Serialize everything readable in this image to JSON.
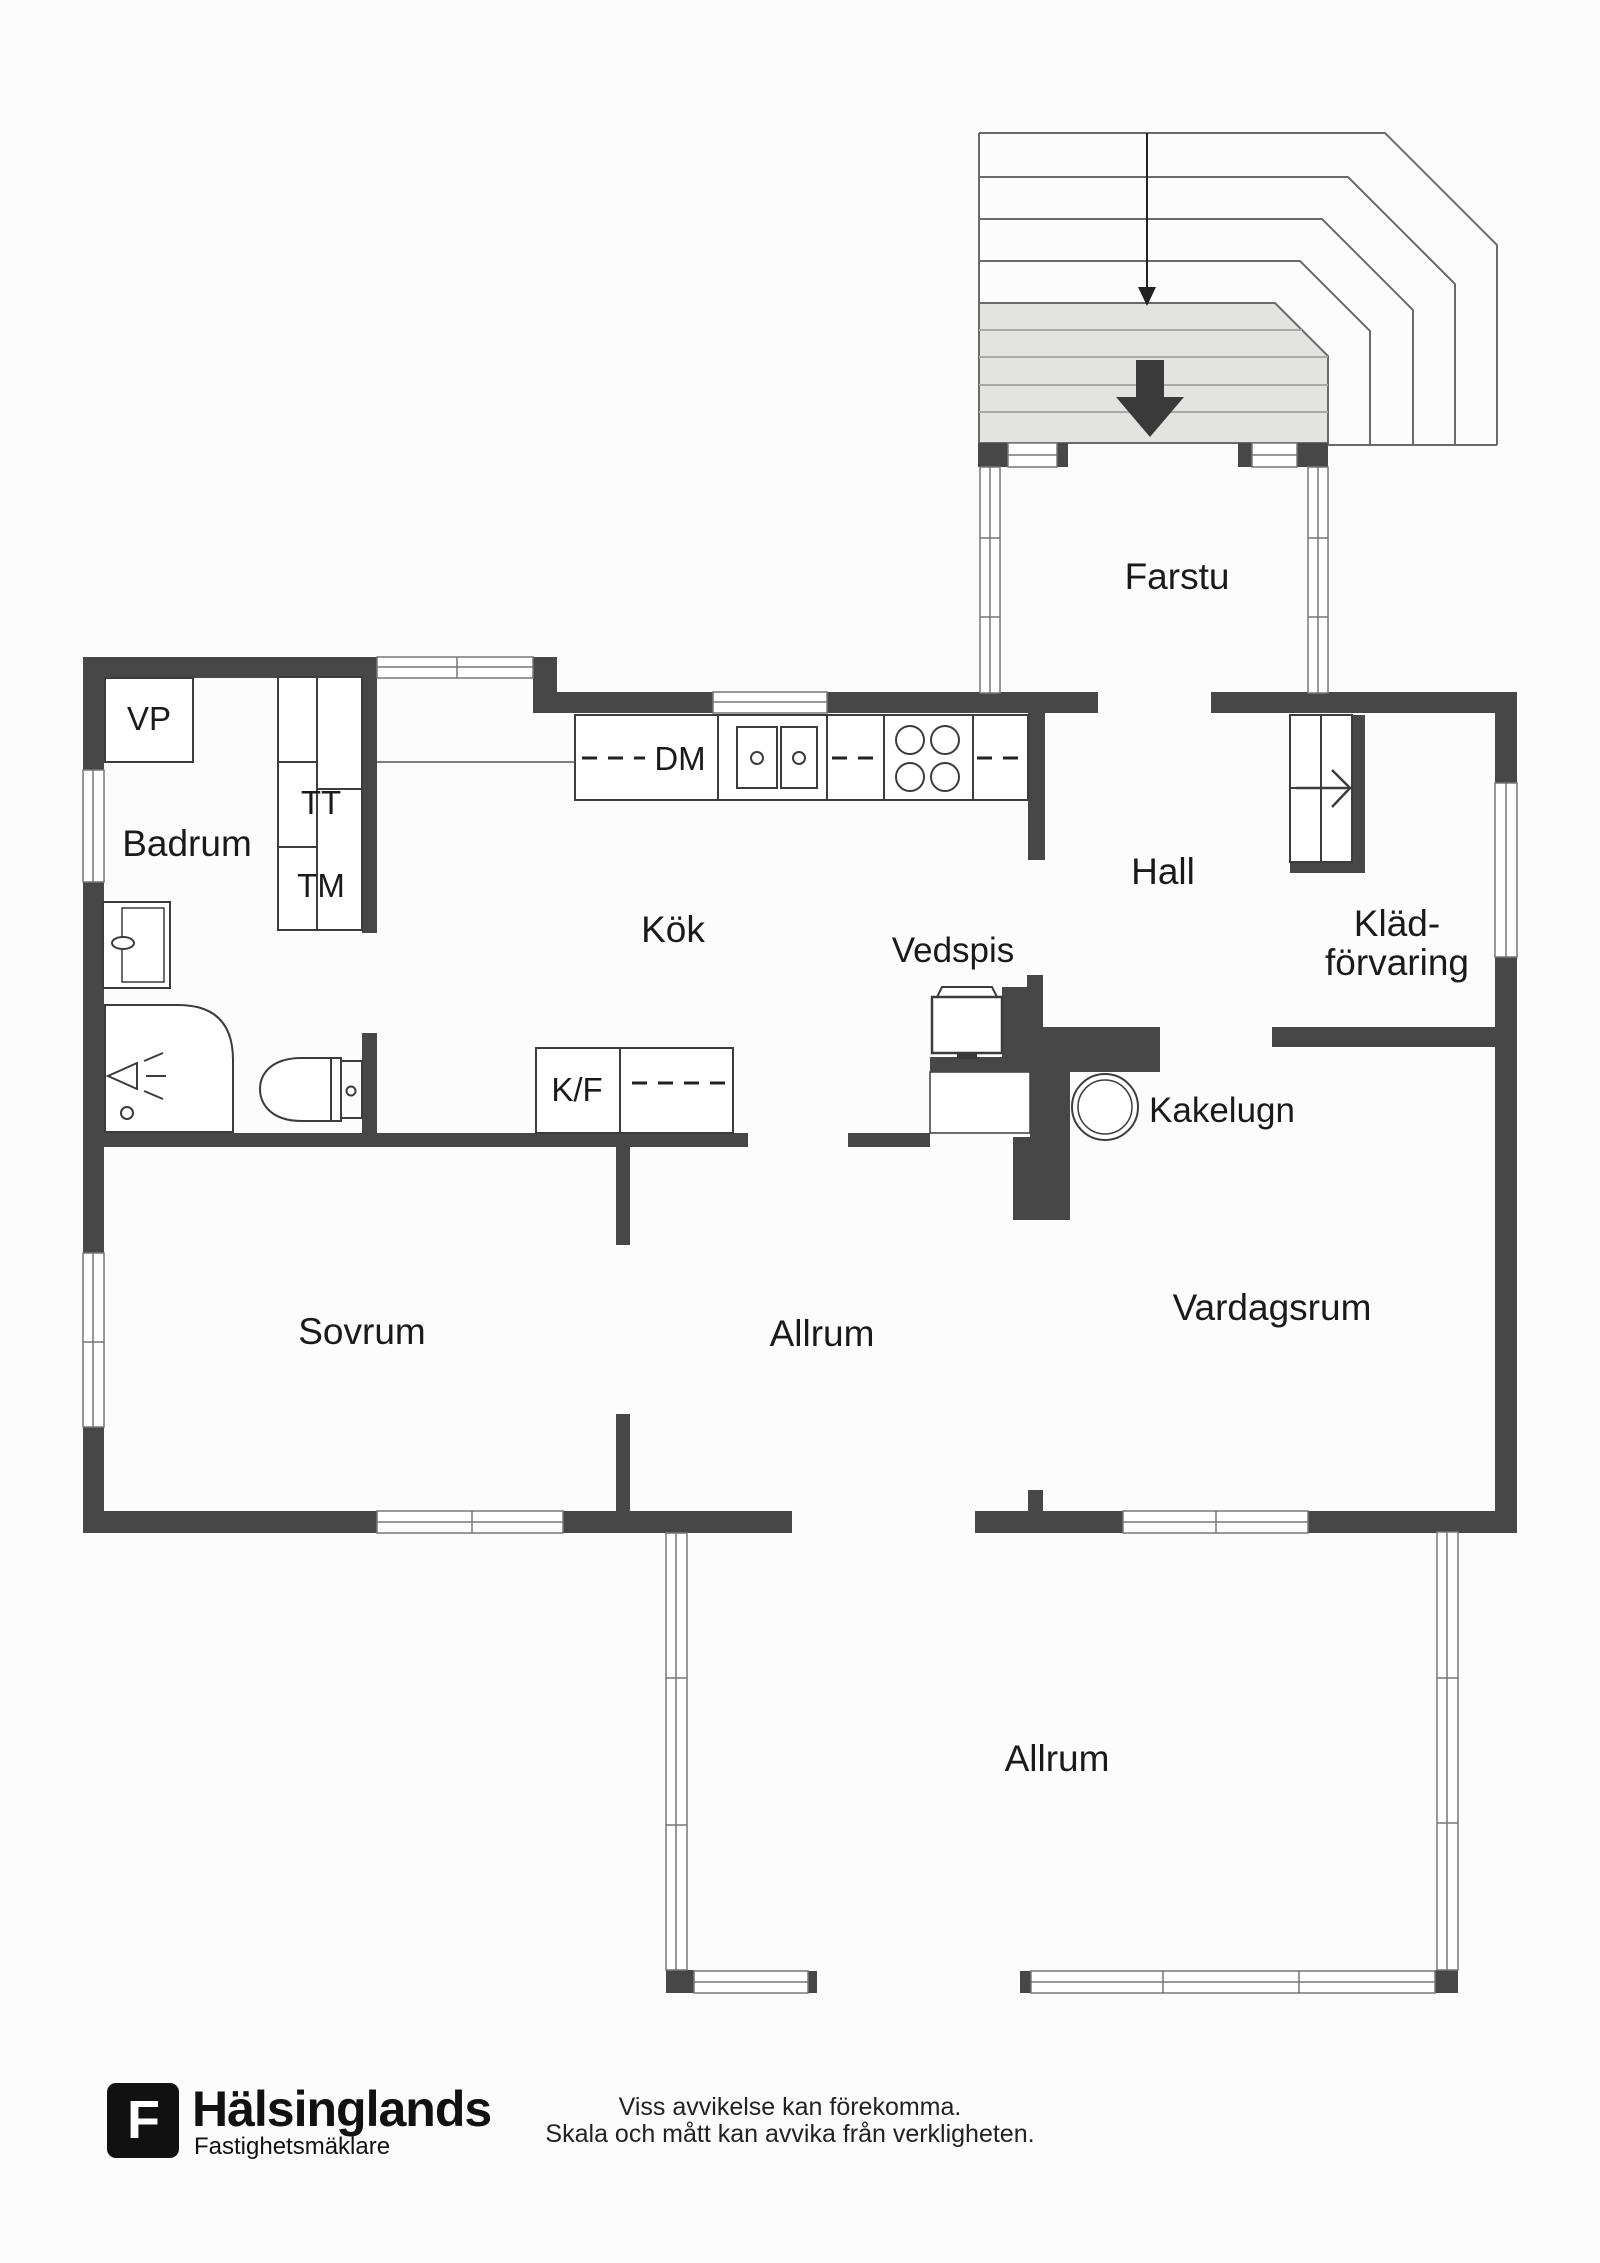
{
  "rooms": {
    "farstu": "Farstu",
    "badrum": "Badrum",
    "kok": "Kök",
    "hall": "Hall",
    "kladforvaring_line1": "Kläd-",
    "kladforvaring_line2": "förvaring",
    "sovrum": "Sovrum",
    "allrum_upper": "Allrum",
    "vardagsrum": "Vardagsrum",
    "allrum_lower": "Allrum"
  },
  "labels": {
    "vp": "VP",
    "tt": "TT",
    "tm": "TM",
    "dm": "DM",
    "kf": "K/F",
    "vedspis": "Vedspis",
    "kakelugn": "Kakelugn"
  },
  "footer": {
    "brand": "Hälsinglands",
    "brand_sub": "Fastighetsmäklare",
    "logo_letter": "F",
    "disclaimer_line1": "Viss avvikelse kan förekomma.",
    "disclaimer_line2": "Skala och mått kan avvika från verkligheten."
  },
  "colors": {
    "wall": "#474747",
    "line": "#3c3c3c",
    "landing-fill": "#e3e3e1",
    "landing-line": "#a9a9a9",
    "text": "#1a1a1a"
  }
}
